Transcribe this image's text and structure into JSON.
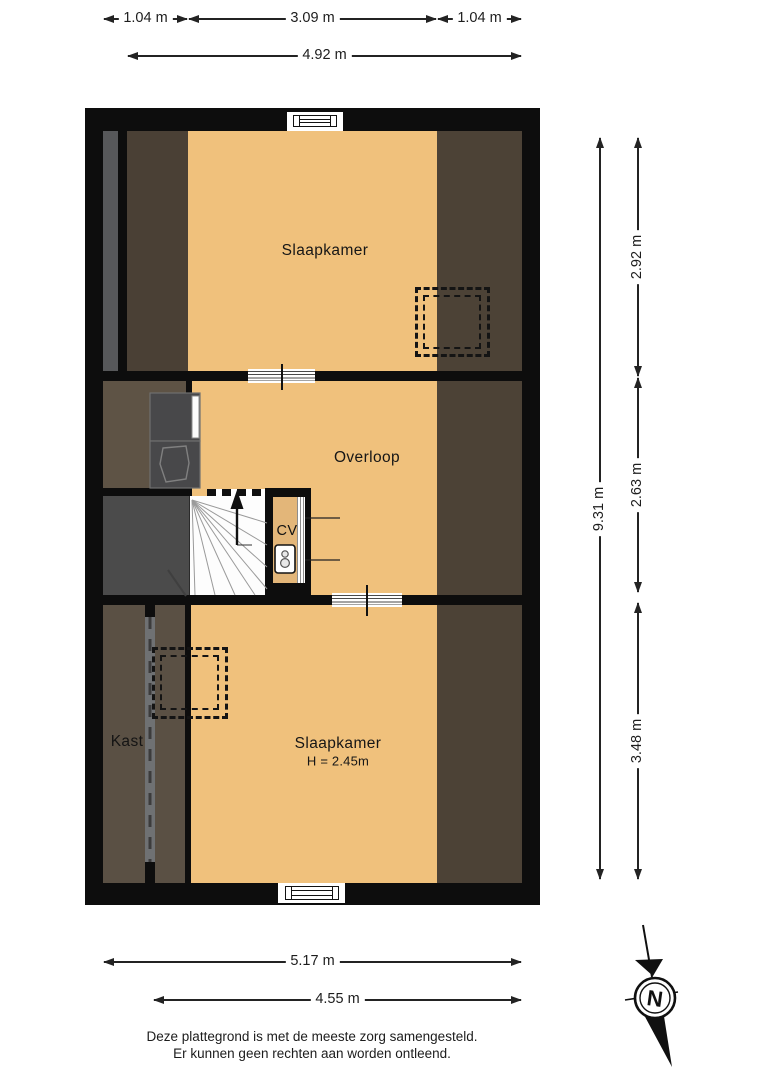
{
  "plan": {
    "type": "floorplan",
    "rooms": {
      "bedroom_north": {
        "label": "Slaapkamer"
      },
      "landing": {
        "label": "Overloop"
      },
      "cv_closet": {
        "label": "CV"
      },
      "closet": {
        "label": "Kast"
      },
      "bedroom_south": {
        "label": "Slaapkamer",
        "height": "H = 2.45m"
      }
    },
    "dimensions": {
      "top_segments": [
        {
          "label": "1.04 m"
        },
        {
          "label": "3.09 m"
        },
        {
          "label": "1.04 m"
        }
      ],
      "top_total": {
        "label": "4.92 m"
      },
      "right_total": {
        "label": "9.31 m"
      },
      "right_segments": [
        {
          "label": "2.92 m"
        },
        {
          "label": "2.63 m"
        },
        {
          "label": "3.48 m"
        }
      ],
      "bottom_total": {
        "label": "5.17 m"
      },
      "bottom_inner": {
        "label": "4.55 m"
      }
    },
    "compass": {
      "label": "N"
    },
    "disclaimer": {
      "line1": "Deze plattegrond is met de meeste zorg samengesteld.",
      "line2": "Er kunnen geen rechten aan worden ontleend."
    },
    "colors": {
      "floor_orange": "#f0c17c",
      "wall_black": "#0d0d0d",
      "eaves_north_left": "#4a4035",
      "eaves_right": "#4c4236",
      "eaves_mid_left": "#5e5345",
      "eaves_south_left": "#5a5044",
      "void_gray": "#4b4b4b",
      "roof_strip_gray": "#57585a",
      "partition_gray": "#6f7173"
    }
  }
}
